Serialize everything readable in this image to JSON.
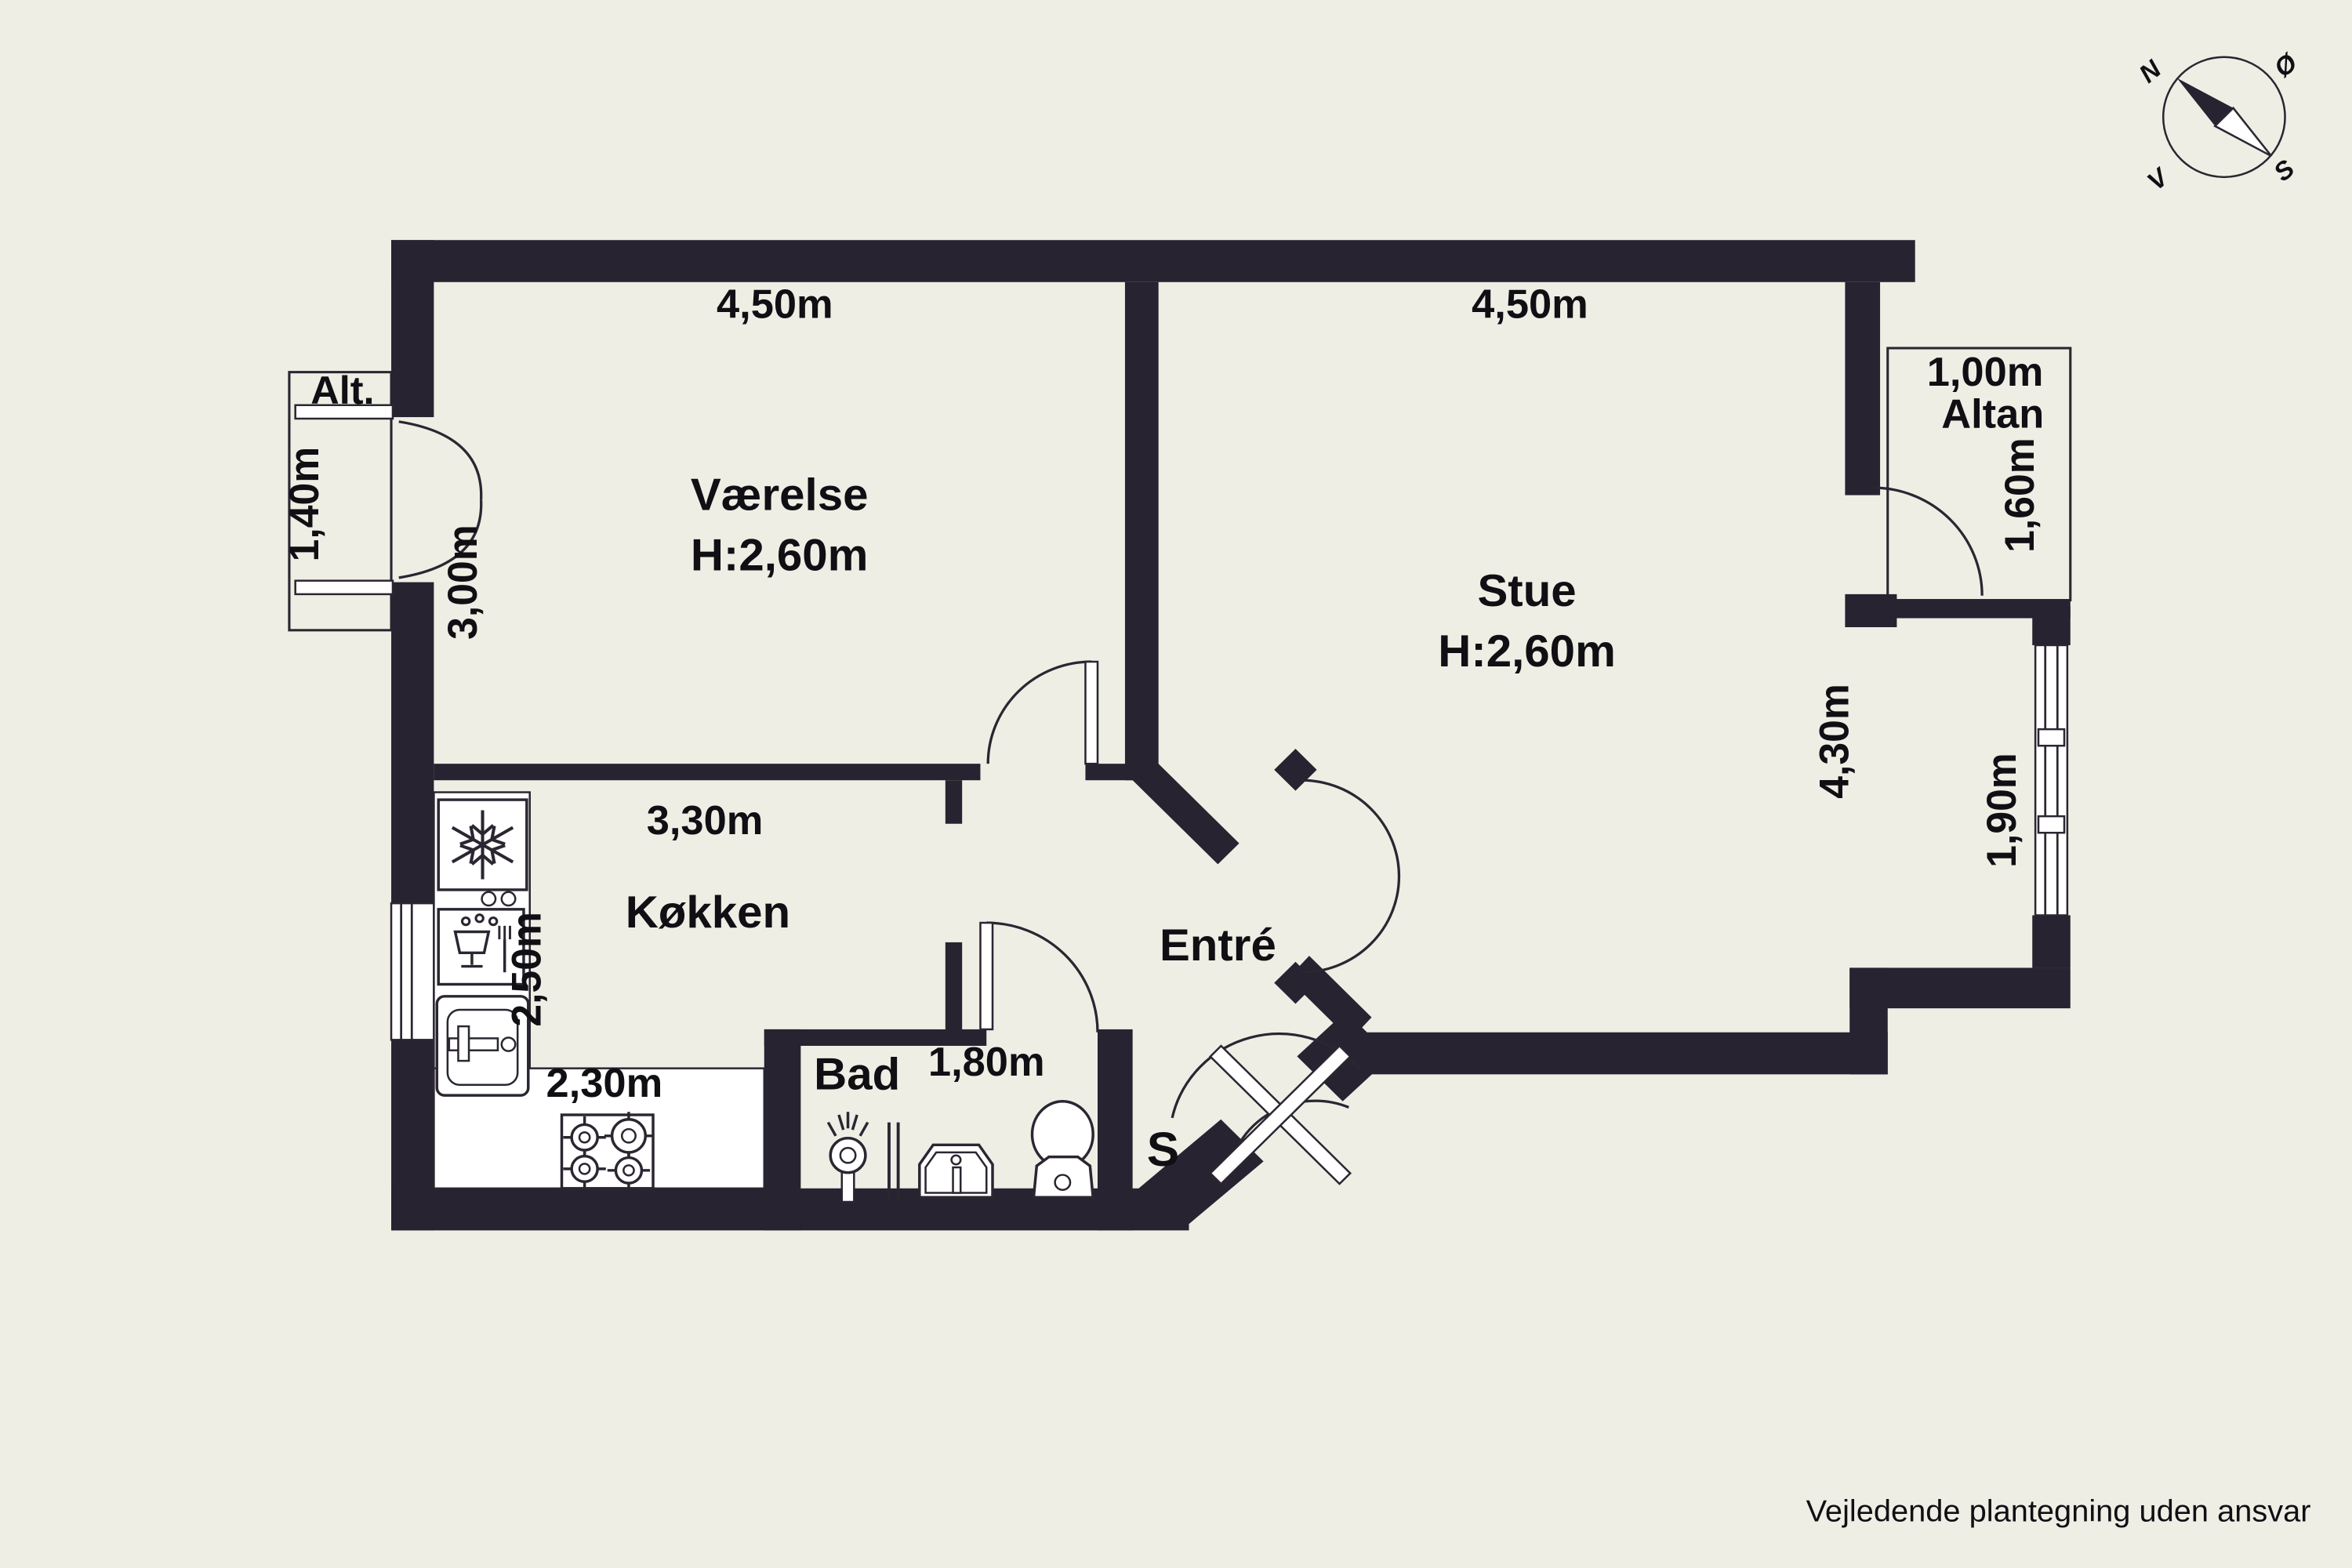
{
  "disclaimer": "Vejledende plantegning uden ansvar",
  "compass": {
    "north": "N",
    "east": "Ø",
    "south": "S",
    "west": "V"
  },
  "rooms": {
    "vaerelse": {
      "name": "Værelse",
      "ceiling": "H:2,60m",
      "width": "4,50m",
      "depth": "3,00m"
    },
    "stue": {
      "name": "Stue",
      "ceiling": "H:2,60m",
      "width": "4,50m",
      "depth": "4,30m"
    },
    "kokken": {
      "name": "Køkken",
      "width": "3,30m",
      "depth": "2,50m",
      "counter": "2,30m"
    },
    "bad": {
      "name": "Bad",
      "width": "1,80m"
    },
    "entre": {
      "name": "Entré"
    },
    "closet": {
      "label": "S"
    }
  },
  "balconies": {
    "alt": {
      "label": "Alt.",
      "door_width": "1,40m"
    },
    "altan": {
      "label": "Altan",
      "depth": "1,00m",
      "door_width": "1,60m",
      "window_width": "1,90m"
    }
  },
  "colors": {
    "wall": "#282331",
    "floor": "#EFEEE5",
    "fixture": "#FFFFFF",
    "text": "#100F14"
  }
}
